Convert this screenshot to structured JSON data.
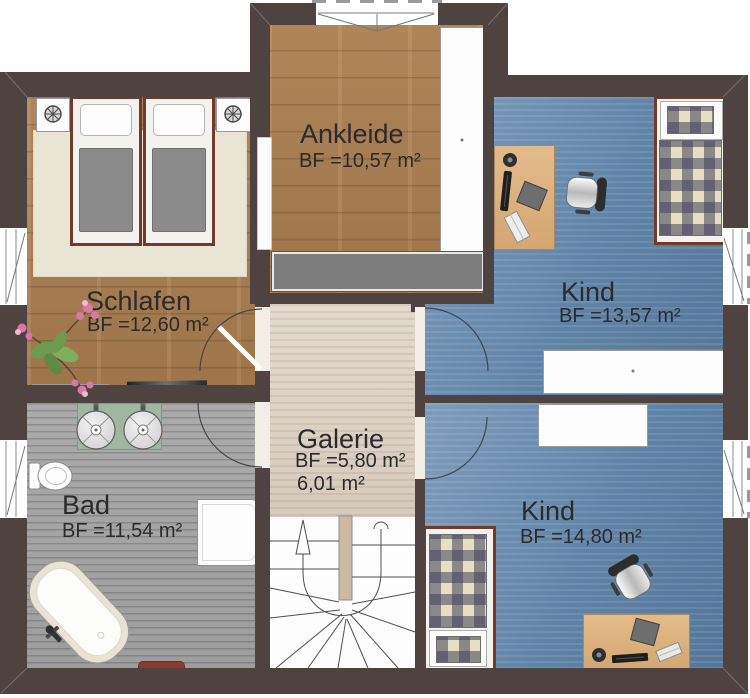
{
  "plan": {
    "rooms": {
      "schlafen": {
        "name": "Schlafen",
        "area": "BF =12,60 m²"
      },
      "ankleide": {
        "name": "Ankleide",
        "area": "BF =10,57 m²"
      },
      "kind_top": {
        "name": "Kind",
        "area": "BF =13,57 m²"
      },
      "kind_bottom": {
        "name": "Kind",
        "area": "BF =14,80 m²"
      },
      "galerie": {
        "name": "Galerie",
        "area": "BF =5,80 m²",
        "area_secondary": "6,01 m²"
      },
      "bad": {
        "name": "Bad",
        "area": "BF =11,54 m²"
      }
    },
    "colors": {
      "wall": "#4e4340",
      "wood_floor": "#ab7f53",
      "blue_floor": "#6a8db0",
      "whitewash_floor": "#ddd3c8",
      "tile_floor": "#a3a3a3",
      "vanity_green": "#9fb6a3",
      "bath_mat_red": "#8e3b32",
      "bed_frame_brown": "#713a29"
    }
  }
}
